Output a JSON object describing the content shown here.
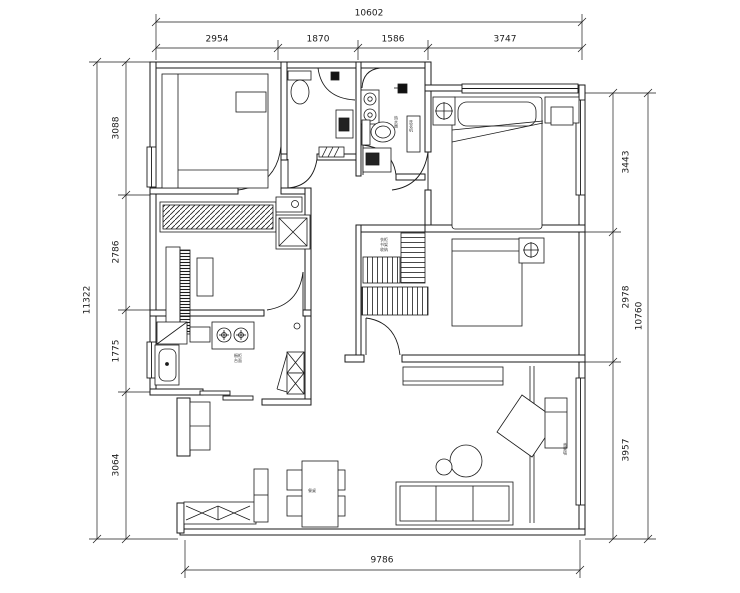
{
  "drawing": {
    "type": "apartment-floor-plan",
    "units": "mm",
    "line_color": "#1a1a1a",
    "background": "#ffffff"
  },
  "dimensions": {
    "top": {
      "overall": "10602",
      "segments": [
        "2954",
        "1870",
        "1586",
        "3747"
      ]
    },
    "left": {
      "overall": "11322",
      "segments": [
        "3088",
        "2786",
        "1775",
        "3064"
      ]
    },
    "right": {
      "overall": "10760",
      "segments": [
        "3443",
        "2978",
        "3957"
      ]
    },
    "bottom": {
      "overall": "9786"
    }
  },
  "annotations": {
    "laundry_fixture": "热水器",
    "laundry_cabinet": "洗衣机",
    "kitchen": "橱柜\n台面",
    "bedroom4_wardrobe": "衣柜\n书架\n收纳",
    "dining_table": "餐桌",
    "tv_wall": "背景墙"
  }
}
